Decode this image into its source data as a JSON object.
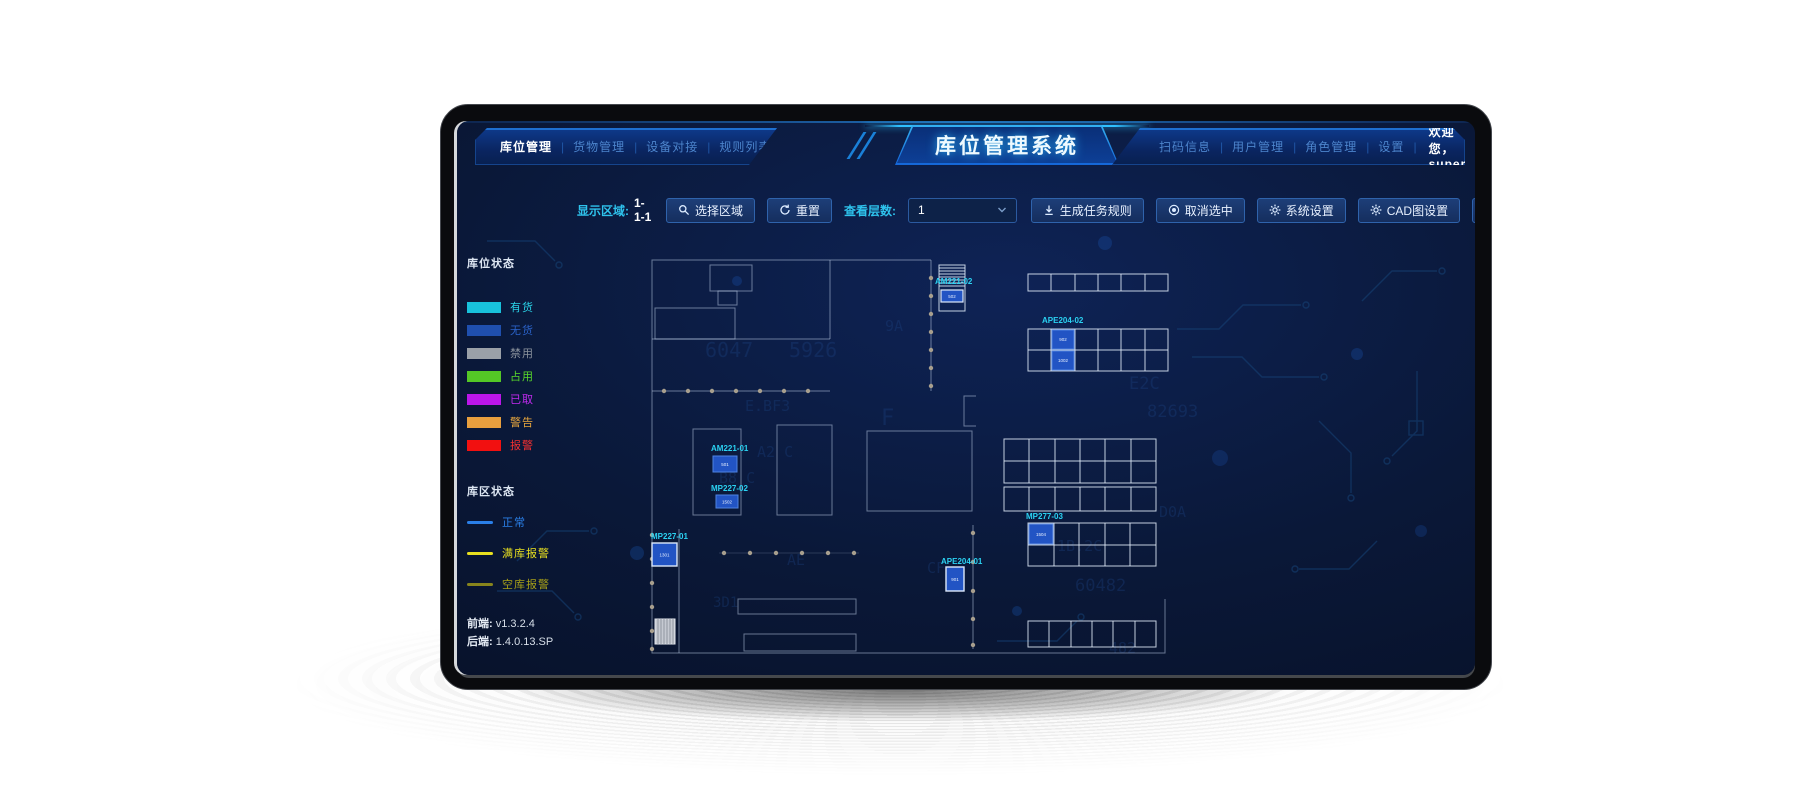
{
  "header": {
    "title": "库位管理系统",
    "left_nav": [
      {
        "label": "库位管理",
        "active": true
      },
      {
        "label": "货物管理",
        "active": false
      },
      {
        "label": "设备对接",
        "active": false
      },
      {
        "label": "规则列表",
        "active": false
      },
      {
        "label": "任务列表",
        "active": false
      }
    ],
    "right_nav": [
      "扫码信息",
      "用户管理",
      "角色管理",
      "设置"
    ],
    "welcome": "欢迎您，super",
    "caret": "▼"
  },
  "toolbar": {
    "display_area_label": "显示区域:",
    "display_area_value": "1-1-1",
    "select_area": "选择区域",
    "reset": "重置",
    "layers_label": "查看层数:",
    "layers_value": "1",
    "generate_rule": "生成任务规则",
    "cancel_selected": "取消选中",
    "system_settings": "系统设置",
    "cad_settings": "CAD图设置",
    "upload_file": "上传文件",
    "icons": {
      "select_area": "magnifier-icon",
      "reset": "refresh-icon",
      "generate_rule": "download-icon",
      "cancel_selected": "fisheye-icon",
      "system_settings": "gear-icon",
      "cad_settings": "gear-icon",
      "upload_file": "upload-icon",
      "layers": "chevron-down-icon"
    }
  },
  "legend": {
    "slot_title": "库位状态",
    "slot_items": [
      {
        "label": "有货",
        "color": "#18c2dc",
        "text_color": "#2ad4e8"
      },
      {
        "label": "无货",
        "color": "#1f4fae",
        "text_color": "#2a62c8"
      },
      {
        "label": "禁用",
        "color": "#9aa0a8",
        "text_color": "#8a929c"
      },
      {
        "label": "占用",
        "color": "#54c726",
        "text_color": "#58d92a"
      },
      {
        "label": "已取",
        "color": "#bb16ea",
        "text_color": "#c32af0"
      },
      {
        "label": "警告",
        "color": "#e89f3e",
        "text_color": "#eaa83e"
      },
      {
        "label": "报警",
        "color": "#f21010",
        "text_color": "#f53030"
      }
    ],
    "zone_title": "库区状态",
    "zone_items": [
      {
        "label": "正常",
        "color": "#2a7fe8",
        "text_color": "#2a7fe8"
      },
      {
        "label": "满库报警",
        "color": "#e8e020",
        "text_color": "#e8e020"
      },
      {
        "label": "空库报警",
        "color": "#a8a018",
        "text_color": "#a8a018"
      }
    ]
  },
  "versions": {
    "frontend_label": "前端:",
    "frontend_value": "v1.3.2.4",
    "backend_label": "后端:",
    "backend_value": "1.4.0.13.SP"
  },
  "map": {
    "stations": [
      {
        "id": "AM221-02",
        "cell": "502"
      },
      {
        "id": "APE204-02",
        "cell_top": "902",
        "cell_bottom": "1002"
      },
      {
        "id": "AM221-01",
        "cell": "501"
      },
      {
        "id": "MP227-02",
        "cell": "1502"
      },
      {
        "id": "MP227-01",
        "cell": "1301"
      },
      {
        "id": "APE204-01",
        "cell": "901"
      },
      {
        "id": "MP277-03",
        "cell": "1504"
      }
    ],
    "bg_glyphs": [
      "6047",
      "5926",
      "E.BF3",
      "A2 C",
      "B8 C",
      "9A",
      "E2C",
      "82693",
      "1B.2C",
      "D0A",
      "60482",
      "482",
      "F",
      "AE",
      "3D1",
      "CF"
    ]
  },
  "colors": {
    "accent_cyan": "#2ec2ec",
    "title_glow": "#2fc0ff",
    "cell_highlight": "#2254c4",
    "cell_border": "#4e82e0",
    "cell_border_selected": "#dce8fa",
    "map_label": "#2bd2f2",
    "wall_line": "#c8d7f0",
    "conveyor_dot": "#a89f8e",
    "screen_bg": "#0a1838"
  }
}
